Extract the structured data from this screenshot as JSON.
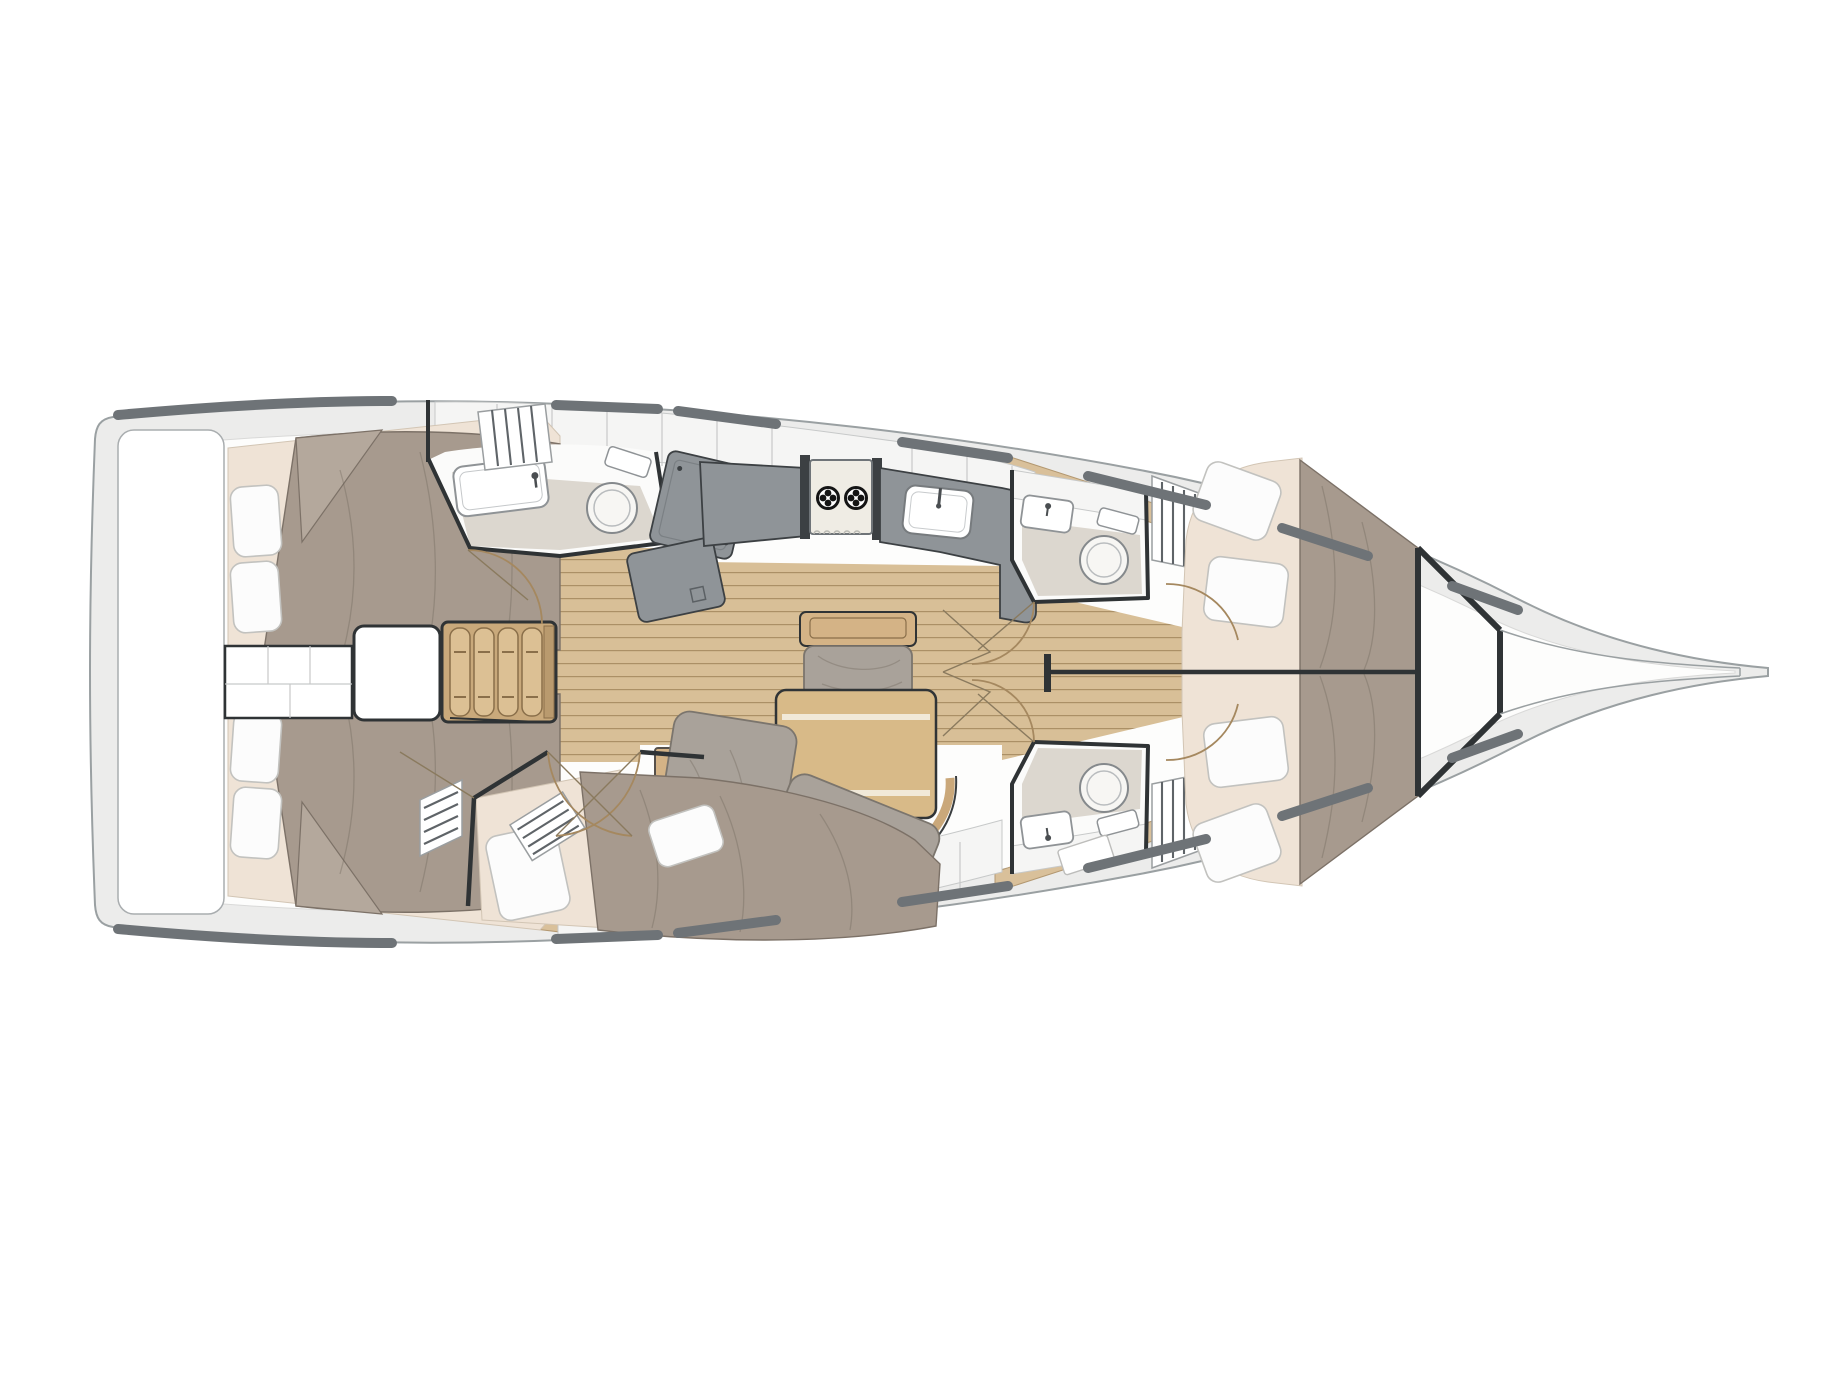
{
  "meta": {
    "title": "Sailboat interior layout plan — overhead view, bow pointing right",
    "type": "yacht-floor-plan"
  },
  "colors": {
    "paper": "#ffffff",
    "hull-line": "#9aa0a2",
    "deck-band": "#ececeb",
    "deck-bar": "#6e7377",
    "interior-white": "#fdfdfc",
    "outline-dark": "#2f3335",
    "cabinet-white": "#f5f5f4",
    "divider-line": "#c7c9c9",
    "wood-floor": "#d8bf97",
    "wood-floor-line": "#ab9066",
    "wood-furniture": "#d4b386",
    "wood-furniture-dark": "#8a6f4a",
    "wood-trim": "#d9c09a",
    "counter-gray": "#8f9498",
    "counter-dark": "#3c4043",
    "stove-body": "#efece4",
    "burner-black": "#141414",
    "bed-duvet": "#a79a8e",
    "bed-duvet-line": "#7c7167",
    "mattress-cream": "#efe3d6",
    "pillow-white": "#fcfcfc",
    "pillow-line": "#c2c2bf",
    "cushion-gray": "#a9a29a",
    "cushion-line": "#7b756d",
    "bath-floor": "#dcd7cf",
    "fixture-line": "#85898c",
    "door-arc": "#a5885f"
  },
  "legend": {
    "rooms": [
      {
        "id": "hull",
        "label": "Hull outline (bow to the right)"
      },
      {
        "id": "stern-lazarette",
        "label": "Stern lazarette / transom locker"
      },
      {
        "id": "aft-cabin-port",
        "label": "Aft double cabin (port)"
      },
      {
        "id": "aft-cabin-starboard",
        "label": "Aft double cabin (starboard)"
      },
      {
        "id": "engine-compartment",
        "label": "Engine / storage compartment"
      },
      {
        "id": "companionway-steps",
        "label": "Companionway steps"
      },
      {
        "id": "aft-head",
        "label": "Aft head with sink and toilet"
      },
      {
        "id": "galley",
        "label": "Galley with 2-burner stove and sink"
      },
      {
        "id": "salon",
        "label": "Saloon with table, bench and corner sofa"
      },
      {
        "id": "third-cabin",
        "label": "Third cabin amidships with berth"
      },
      {
        "id": "forward-head-upper",
        "label": "Forward head (starboard) with sink and toilet"
      },
      {
        "id": "forward-head-lower",
        "label": "Forward head (port) with sink and toilet"
      },
      {
        "id": "forward-cabin",
        "label": "Forward owner's cabin with V-berth"
      },
      {
        "id": "chain-locker",
        "label": "Bow chain locker"
      }
    ],
    "furniture": [
      {
        "id": "salon-table",
        "label": "Folding saloon table with two leaf strips"
      },
      {
        "id": "stairs",
        "label": "Four wooden companionway treads"
      },
      {
        "id": "mast-post",
        "label": "Mast post and centerline beam"
      },
      {
        "id": "louver-locker",
        "label": "Louvered hanging locker"
      }
    ]
  },
  "counts": {
    "cabins": 4,
    "heads": 3,
    "stove_burners": 2,
    "stair_treads": 4,
    "pillows_aft_port": 2,
    "pillows_aft_starboard": 2,
    "pillows_third_cabin": 2,
    "pillows_forward_cabin": 4,
    "table_leaf_strips": 2
  }
}
